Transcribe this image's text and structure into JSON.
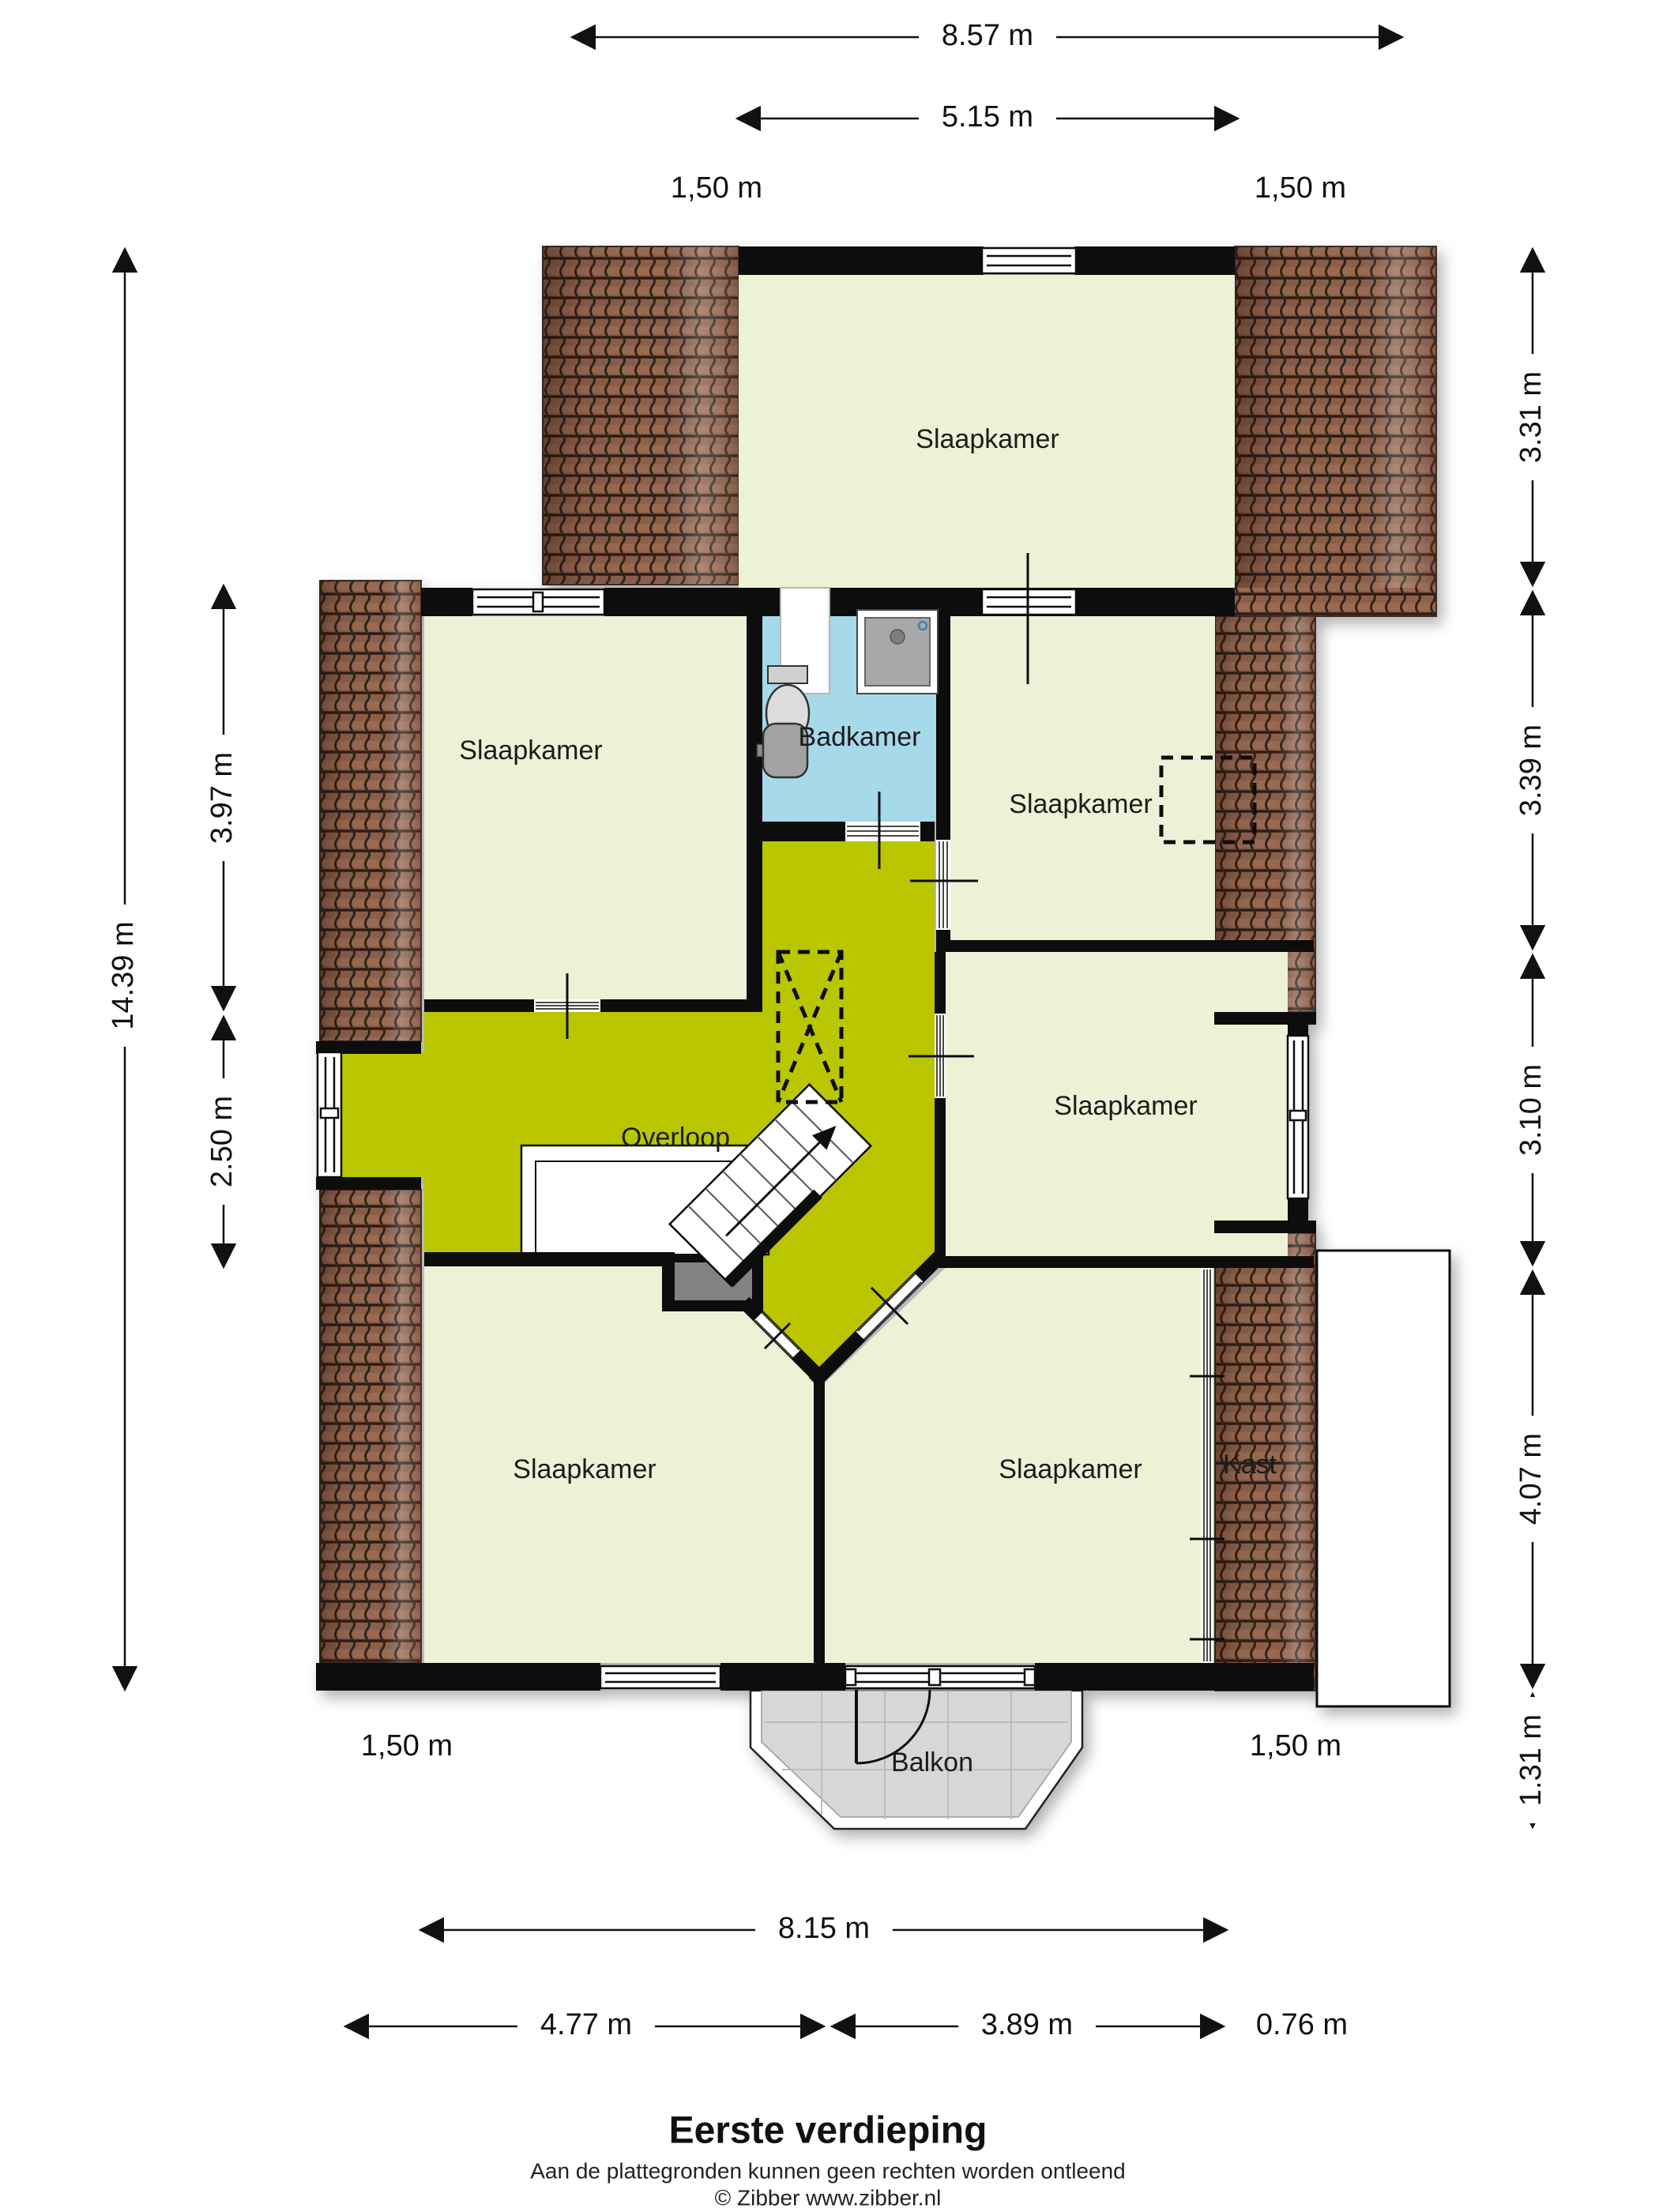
{
  "meta": {
    "title": "Eerste verdieping",
    "disclaimer": "Aan de plattegronden kunnen geen rechten worden ontleend",
    "copyright": "© Zibber www.zibber.nl"
  },
  "rooms": {
    "bedroom_top": {
      "label": "Slaapkamer"
    },
    "bedroom_left": {
      "label": "Slaapkamer"
    },
    "bathroom": {
      "label": "Badkamer"
    },
    "bedroom_right_upper": {
      "label": "Slaapkamer"
    },
    "landing": {
      "label": "Overloop"
    },
    "bedroom_right_mid": {
      "label": "Slaapkamer"
    },
    "bedroom_bottom_left": {
      "label": "Slaapkamer"
    },
    "bedroom_bottom_center": {
      "label": "Slaapkamer"
    },
    "closet": {
      "label": "Kast"
    },
    "balcony": {
      "label": "Balkon"
    }
  },
  "dimensions": {
    "overall_width": "8.57 m",
    "top_room_width": "5.15 m",
    "eave_top_left": "1,50 m",
    "eave_top_right": "1,50 m",
    "overall_height": "14.39 m",
    "left_upper": "3.97 m",
    "left_lower": "2.50 m",
    "right_top": "3.31 m",
    "right_upper_mid": "3.39 m",
    "right_lower_mid": "3.10 m",
    "right_bottom": "4.07 m",
    "right_balcony": "1.31 m",
    "bottom_total": "8.15 m",
    "bottom_left": "4.77 m",
    "bottom_center": "3.89 m",
    "bottom_right": "0.76 m",
    "eave_bottom_left": "1,50 m",
    "eave_bottom_right": "1,50 m"
  },
  "colors": {
    "room_fill": "#edf2d6",
    "landing_fill": "#b9c606",
    "bathroom_fill": "#a6d9ea",
    "roof_fill": "#8d5f4a",
    "wall": "#0d0d0d",
    "balcony_fill": "#d7d7d7"
  }
}
